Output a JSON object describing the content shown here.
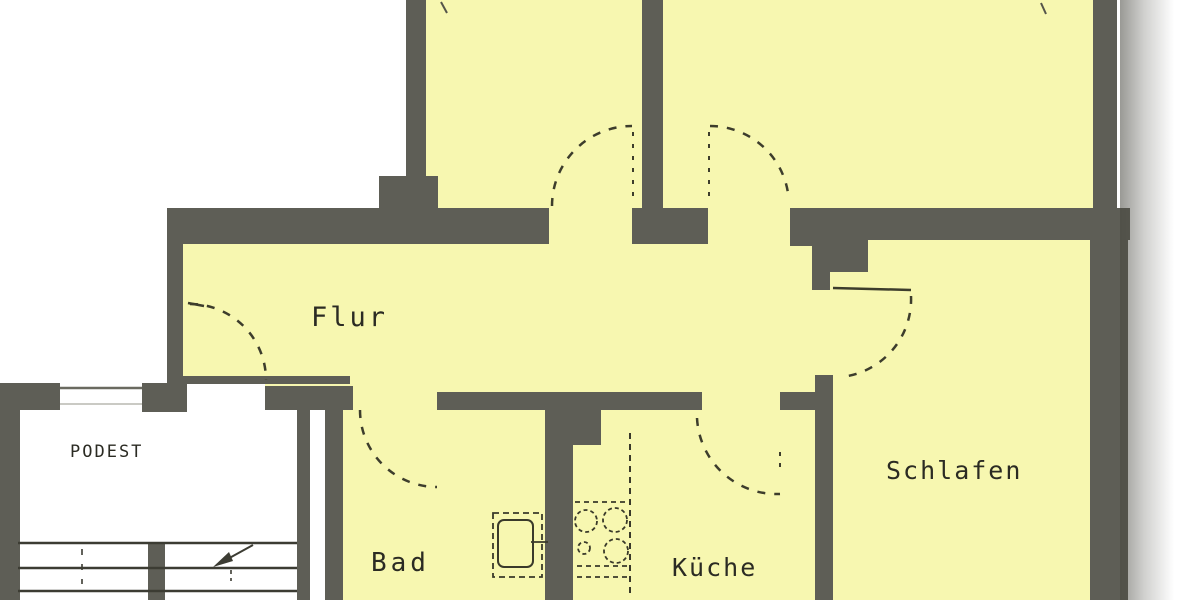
{
  "plan": {
    "title": "apartment-floor-plan",
    "rooms": [
      {
        "id": "flur",
        "label": "Flur"
      },
      {
        "id": "schlafen",
        "label": "Schlafen"
      },
      {
        "id": "kueche",
        "label": "Küche"
      },
      {
        "id": "bad",
        "label": "Bad"
      },
      {
        "id": "podest",
        "label": "PODEST"
      }
    ],
    "colors": {
      "room_fill": "#f7f7b0",
      "wall": "#5e5e56",
      "background": "#ffffff",
      "line": "#3d3d2c",
      "text": "#2b2b23"
    }
  }
}
